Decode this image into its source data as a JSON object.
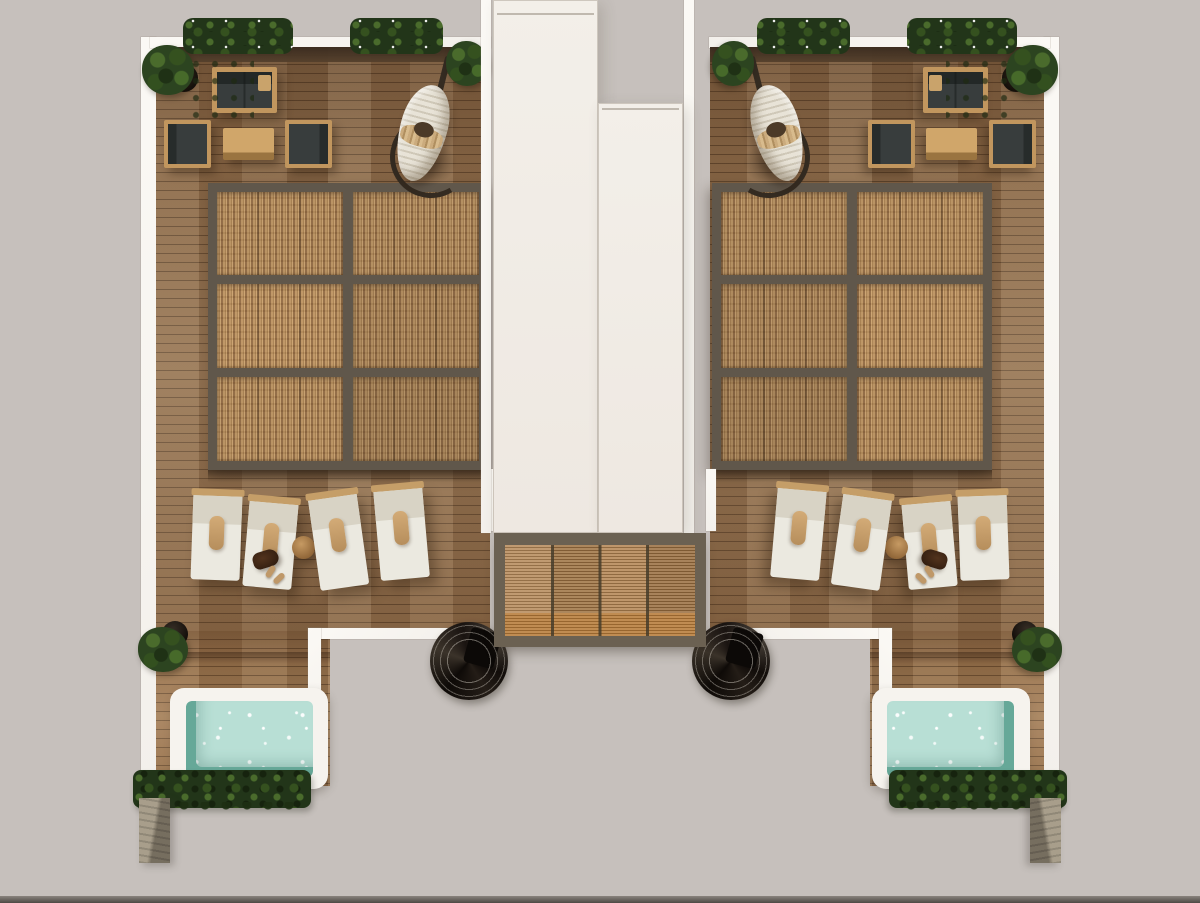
{
  "meta": {
    "scene_type": "architectural-top-view-render",
    "subject": "symmetric rooftop terrace plan with two wooden deck wings, pergolas, plunge pools and central entry canopy",
    "visible_text": "",
    "width_px": 1200,
    "height_px": 903
  },
  "palette": {
    "background": "#c6c0bc",
    "wall_white": "#f3f0eb",
    "wall_bright": "#fbf9f5",
    "deck_base": "#8d6c4b",
    "pergola_frame": "#60574b",
    "pergola_panel_a": "#b68f5f",
    "pergola_panel_b": "#8d6741",
    "canopy_frame": "#6b6152",
    "canopy_slat_a": "#bb9265",
    "canopy_slat_b": "#8c6439",
    "landing_a": "#c08c52",
    "landing_b": "#98662f",
    "pool_frame": "#f6f3ee",
    "pool_water": "#b8dfd5",
    "pool_wall": "#66a898",
    "hedge_dark": "#223519",
    "hedge_mid": "#35511f",
    "hedge_light": "#4a6b2c",
    "stone_light": "#a89e8b",
    "stone_dark": "#766e5f",
    "cushion": "#383d3d",
    "wood_frame": "#c1965e",
    "lounger_body": "#ebe9e0",
    "lounger_back": "#d8d3c5",
    "lounger_pillow": "#c9a273",
    "lounger_bar": "#c59e68",
    "sandal": "#bf9868",
    "swing_fabric_a": "#e8e3d7",
    "swing_fabric_b": "#cfc8b8",
    "swing_stand": "#342b21",
    "shadow_soft": "rgba(45,28,14,0.38)"
  },
  "scene": {
    "wings": [
      {
        "id": "terrace-wing-left",
        "mirrored": false
      },
      {
        "id": "terrace-wing-right",
        "mirrored": true
      }
    ],
    "furniture": {
      "planters": [
        {
          "x": 188,
          "y": 24,
          "w": 100,
          "h": 26
        },
        {
          "x": 355,
          "y": 24,
          "w": 83,
          "h": 26
        }
      ],
      "pots": [
        {
          "px": 170,
          "py": 64,
          "pd": 28,
          "fx": 142,
          "fy": 45,
          "fw": 52,
          "fh": 50,
          "scatter": true
        },
        {
          "px": 459,
          "py": 49,
          "pd": 21,
          "fx": 446,
          "fy": 41,
          "fw": 42,
          "fh": 45
        },
        {
          "px": 162,
          "py": 621,
          "pd": 26,
          "fx": 138,
          "fy": 627,
          "fw": 50,
          "fh": 45
        }
      ],
      "loungers": [
        {
          "x": 192,
          "y": 493,
          "w": 49,
          "h": 87,
          "rot": 2
        },
        {
          "x": 246,
          "y": 500,
          "w": 49,
          "h": 88,
          "rot": 5,
          "bag": true
        },
        {
          "type": "table",
          "x": 292,
          "y": 536,
          "d": 23
        },
        {
          "x": 314,
          "y": 494,
          "w": 49,
          "h": 94,
          "rot": -8
        },
        {
          "x": 377,
          "y": 487,
          "w": 49,
          "h": 92,
          "rot": -5
        }
      ]
    },
    "inventory": {
      "terrace_wings": 2,
      "pergolas": 2,
      "pergola_panels_each": 6,
      "plunge_pools": 2,
      "sun_loungers_each": 4,
      "sofas": 2,
      "armchairs": 4,
      "coffee_tables": 2,
      "hanging_egg_chairs": 2,
      "spiral_staircases": 2,
      "planter_boxes_each": 2,
      "hedges": 2,
      "stone_pillars": 2
    }
  }
}
